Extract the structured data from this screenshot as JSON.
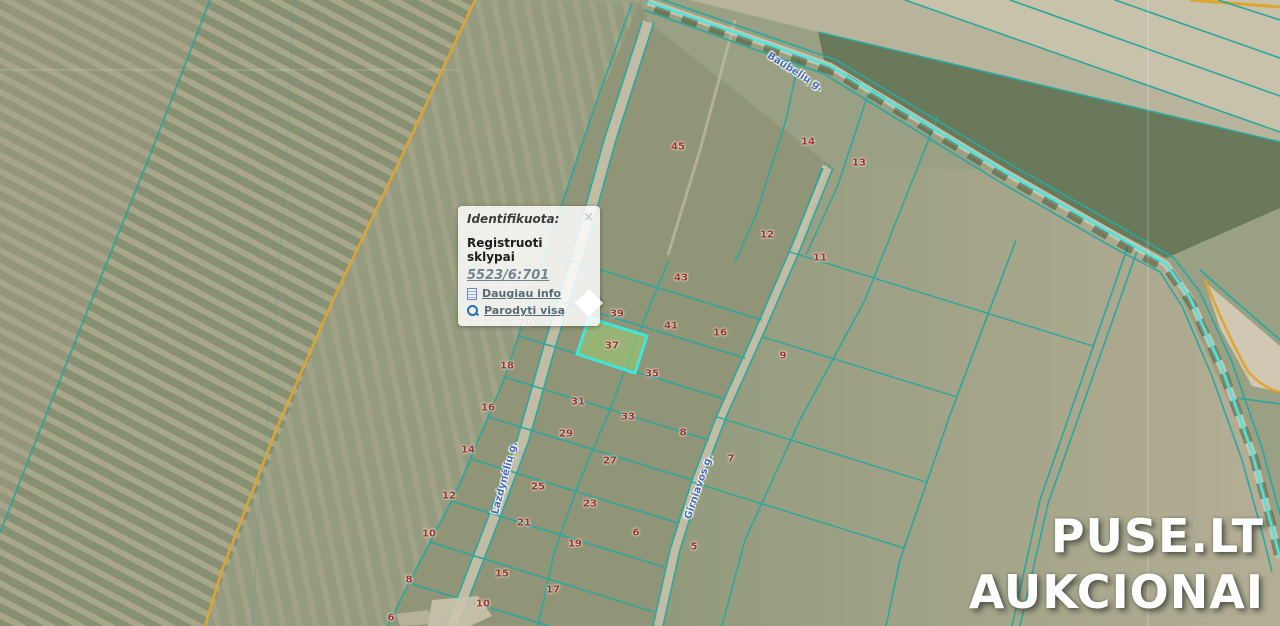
{
  "popup": {
    "title": "Identifikuota:",
    "close_label": "×",
    "section_title": "Registruoti sklypai",
    "parcel_id": "5523/6:701",
    "links": [
      {
        "label": "Daugiau info",
        "icon": "info-doc-icon"
      },
      {
        "label": "Parodyti visą",
        "icon": "magnifier-icon"
      }
    ]
  },
  "watermark": {
    "line1": "PUSE.LT",
    "line2": "AUKCIONAI"
  },
  "colors": {
    "cadastral_line": "#2aa79e",
    "road_highlight": "#47e8e2",
    "selected_parcel_stroke": "#3fe6da",
    "selected_parcel_fill": "rgba(158,206,116,0.55)",
    "field_boundary_orange": "#dfa52f",
    "parcel_number_red": "#943634",
    "street_label_blue": "#4a6db3"
  },
  "map": {
    "road_labels": [
      {
        "name": "Baubelių g.",
        "x": 795,
        "y": 72,
        "rot": 32
      },
      {
        "name": "Lazdynėlių g.",
        "x": 505,
        "y": 478,
        "rot": -75
      },
      {
        "name": "Girniavos g.",
        "x": 699,
        "y": 487,
        "rot": -71
      }
    ],
    "parcel_labels": [
      {
        "n": "45",
        "x": 678,
        "y": 147
      },
      {
        "n": "14",
        "x": 808,
        "y": 142
      },
      {
        "n": "13",
        "x": 859,
        "y": 163
      },
      {
        "n": "12",
        "x": 767,
        "y": 235
      },
      {
        "n": "11",
        "x": 820,
        "y": 258
      },
      {
        "n": "43",
        "x": 681,
        "y": 278
      },
      {
        "n": "39",
        "x": 617,
        "y": 314
      },
      {
        "n": "41",
        "x": 671,
        "y": 326
      },
      {
        "n": "16",
        "x": 720,
        "y": 333
      },
      {
        "n": "9",
        "x": 783,
        "y": 356
      },
      {
        "n": "20",
        "x": 525,
        "y": 323
      },
      {
        "n": "18",
        "x": 507,
        "y": 366
      },
      {
        "n": "37",
        "x": 612,
        "y": 346
      },
      {
        "n": "35",
        "x": 652,
        "y": 374
      },
      {
        "n": "16",
        "x": 488,
        "y": 408
      },
      {
        "n": "31",
        "x": 578,
        "y": 402
      },
      {
        "n": "33",
        "x": 628,
        "y": 417
      },
      {
        "n": "8",
        "x": 683,
        "y": 433
      },
      {
        "n": "29",
        "x": 566,
        "y": 434
      },
      {
        "n": "14",
        "x": 468,
        "y": 450
      },
      {
        "n": "27",
        "x": 610,
        "y": 461
      },
      {
        "n": "7",
        "x": 731,
        "y": 459
      },
      {
        "n": "25",
        "x": 538,
        "y": 487
      },
      {
        "n": "23",
        "x": 590,
        "y": 504
      },
      {
        "n": "12",
        "x": 449,
        "y": 496
      },
      {
        "n": "21",
        "x": 524,
        "y": 523
      },
      {
        "n": "19",
        "x": 575,
        "y": 544
      },
      {
        "n": "6",
        "x": 636,
        "y": 533
      },
      {
        "n": "10",
        "x": 429,
        "y": 534
      },
      {
        "n": "15",
        "x": 502,
        "y": 574
      },
      {
        "n": "17",
        "x": 553,
        "y": 590
      },
      {
        "n": "5",
        "x": 694,
        "y": 547
      },
      {
        "n": "10",
        "x": 483,
        "y": 604
      },
      {
        "n": "8",
        "x": 409,
        "y": 580
      },
      {
        "n": "6",
        "x": 391,
        "y": 618
      }
    ],
    "highlight": {
      "points": "589,318 647,336 635,373 577,354",
      "fill": "rgba(158,206,116,0.55)",
      "stroke": "#3fe6da",
      "label": "37"
    },
    "layers": [
      {
        "t": "pg",
        "p": "0,0 1280,0 1280,626 0,626",
        "f": "#99a083",
        "n": "base-field"
      },
      {
        "t": "pg",
        "p": "0,0 475,0 333,300 205,626 0,626",
        "f": "url(#stripesL)",
        "n": "striped-field-west"
      },
      {
        "t": "pg",
        "p": "0,0 210,0 93,297 0,533",
        "f": "#a89f86",
        "o": 0.4,
        "n": "pale-field-northwest"
      },
      {
        "t": "pg",
        "p": "475,0 640,2 590,120 545,255 503,382 458,488 408,585 388,626 205,626 333,300",
        "f": "url(#stripesM)",
        "o": 0.85,
        "n": "field-strip-mid"
      },
      {
        "t": "pg",
        "p": "640,2 590,120 545,255 503,382 458,488 408,585 388,626 663,626 680,550 702,480 727,415 763,335 800,250 833,168 648,22",
        "f": "#909577",
        "n": "parcel-block-field"
      },
      {
        "t": "pg",
        "p": "833,168 1000,170 1166,264 1252,452 1280,555 1280,626 663,626 680,550 702,480 727,415 763,335 800,250",
        "f": "url(#gradE)",
        "n": "east-field"
      },
      {
        "t": "pg",
        "p": "690,0 1280,0 1280,142 818,32",
        "f": "#b8b39b",
        "n": "north-strip-field"
      },
      {
        "t": "pg",
        "p": "905,0 1280,0 1280,132",
        "f": "#c8c2ab",
        "n": "northeast-pale-field"
      },
      {
        "t": "pg",
        "p": "818,32 1280,142 1280,208 1166,258 1000,170 824,60",
        "f": "#6a795a",
        "n": "dark-tree-band"
      },
      {
        "t": "pg",
        "p": "1205,282 1280,346 1280,392 1252,386 1220,328",
        "f": "#d0c8b2",
        "n": "pale-bay-east"
      },
      {
        "t": "pl",
        "p": "0,70 460,70",
        "s": "#ffffff",
        "w": 1,
        "o": 0.22,
        "n": "grid-line-horizontal"
      },
      {
        "t": "pl",
        "p": "293,0 287,160 272,360 258,530 252,626",
        "s": "#2aa79e",
        "w": 1,
        "o": 0.3,
        "n": "faint-boundary"
      },
      {
        "t": "pl",
        "p": "210,0 152,150 93,297 40,430 0,533",
        "s": "#2da195",
        "w": 2,
        "o": 0.8,
        "n": "west-boundary-line"
      },
      {
        "t": "pl",
        "p": "475,0 400,160 333,300 276,430 222,570 205,626",
        "s": "#dfa52f",
        "w": 2.5,
        "o": 0.95,
        "n": "orange-boundary-line"
      },
      {
        "t": "pl",
        "p": "632,3 590,120 545,255 503,382 458,488 408,585 388,626",
        "s": "#2aa79e",
        "w": 1.6,
        "n": "block-west-boundary"
      },
      {
        "t": "pl",
        "p": "735,20 700,150 668,255",
        "s": "#c9c3aa",
        "w": 3,
        "o": 0.6,
        "n": "field-lane"
      },
      {
        "t": "pl",
        "p": "800,55 786,120 756,215 735,262",
        "s": "#2aa79e",
        "w": 1.5,
        "n": "upper-parcel-line"
      },
      {
        "t": "pl",
        "p": "826,166 796,248",
        "s": "#ccc6ae",
        "w": 7,
        "o": 0.9,
        "n": "gravel-strip"
      },
      {
        "t": "pl",
        "p": "830,164 800,246",
        "s": "#2aa79e",
        "w": 1.3,
        "n": "gravel-strip-edge"
      },
      {
        "t": "pl",
        "p": "822,168 792,250",
        "s": "#2aa79e",
        "w": 1.3,
        "n": "gravel-strip-edge"
      },
      {
        "t": "pl",
        "p": "870,88 838,185 806,255",
        "s": "#2aa79e",
        "w": 1.5,
        "n": "upper-parcel-line"
      },
      {
        "t": "pl",
        "p": "938,116 865,300 800,420 745,540 722,626",
        "s": "#2aa79e",
        "w": 1.5,
        "n": "east-column-line"
      },
      {
        "t": "pl",
        "p": "648,22 610,140 578,255 550,345 523,440 495,515 470,580 452,626",
        "s": "#c6c0a7",
        "w": 11,
        "o": 0.9,
        "n": "road-west-surface"
      },
      {
        "t": "pl",
        "p": "642,22 604,140 572,255 544,345 517,440 489,515 464,580 446,626",
        "s": "#2aa79e",
        "w": 1.6,
        "n": "road-west-edge"
      },
      {
        "t": "pl",
        "p": "654,22 616,140 584,255 556,345 529,440 501,515 476,580 458,626",
        "s": "#2aa79e",
        "w": 1.6,
        "n": "road-west-edge"
      },
      {
        "t": "pl",
        "p": "828,168 795,250 758,335 722,415 697,480 675,550 658,626",
        "s": "#c6c0a7",
        "w": 9,
        "o": 0.9,
        "n": "road-east-surface"
      },
      {
        "t": "pl",
        "p": "823,168 790,250 753,335 717,415 692,480 670,550 653,626",
        "s": "#2aa79e",
        "w": 1.6,
        "n": "road-east-edge"
      },
      {
        "t": "pl",
        "p": "833,168 800,250 763,335 727,415 702,480 680,550 663,626",
        "s": "#2aa79e",
        "w": 1.6,
        "n": "road-east-edge"
      },
      {
        "t": "pl",
        "p": "668,262 640,330 610,410 580,480 555,550 538,626",
        "s": "#2aa79e",
        "w": 1.5,
        "n": "middle-column-line"
      },
      {
        "t": "pl",
        "p": "546,253 762,320",
        "s": "#2aa79e",
        "w": 1.5,
        "n": "parcel-row"
      },
      {
        "t": "pl",
        "p": "533,293 745,358",
        "s": "#2aa79e",
        "w": 1.5,
        "n": "parcel-row"
      },
      {
        "t": "pl",
        "p": "519,336 724,399",
        "s": "#2aa79e",
        "w": 1.5,
        "n": "parcel-row"
      },
      {
        "t": "pl",
        "p": "504,377 709,440",
        "s": "#2aa79e",
        "w": 1.5,
        "n": "parcel-row"
      },
      {
        "t": "pl",
        "p": "488,417 692,480",
        "s": "#2aa79e",
        "w": 1.5,
        "n": "parcel-row"
      },
      {
        "t": "pl",
        "p": "471,459 678,523",
        "s": "#2aa79e",
        "w": 1.5,
        "n": "parcel-row"
      },
      {
        "t": "pl",
        "p": "451,501 664,567",
        "s": "#2aa79e",
        "w": 1.5,
        "n": "parcel-row"
      },
      {
        "t": "pl",
        "p": "430,542 654,612",
        "s": "#2aa79e",
        "w": 1.5,
        "n": "parcel-row"
      },
      {
        "t": "pl",
        "p": "412,584 549,626",
        "s": "#2aa79e",
        "w": 1.5,
        "n": "parcel-row"
      },
      {
        "t": "pl",
        "p": "790,252 1093,346",
        "s": "#2aa79e",
        "w": 1.4,
        "n": "east-parcel-row"
      },
      {
        "t": "pl",
        "p": "763,337 957,397",
        "s": "#2aa79e",
        "w": 1.4,
        "n": "east-parcel-row"
      },
      {
        "t": "pl",
        "p": "717,417 926,482",
        "s": "#2aa79e",
        "w": 1.4,
        "n": "east-parcel-row"
      },
      {
        "t": "pl",
        "p": "692,482 904,548",
        "s": "#2aa79e",
        "w": 1.4,
        "n": "east-parcel-row"
      },
      {
        "t": "pl",
        "p": "1128,246 1040,500 1012,626",
        "s": "#2aa79e",
        "w": 1.6,
        "n": "long-field-line"
      },
      {
        "t": "pl",
        "p": "1137,251 1048,504 1020,626",
        "s": "#2aa79e",
        "w": 1.6,
        "n": "long-field-line"
      },
      {
        "t": "pl",
        "p": "1016,240 950,415 900,560 886,626",
        "s": "#2aa79e",
        "w": 1.6,
        "n": "long-field-line"
      },
      {
        "t": "pl",
        "p": "1200,270 1280,340",
        "s": "#2aa79e",
        "w": 1.6,
        "n": "east-edge-line"
      },
      {
        "t": "pl",
        "p": "1237,398 1280,404",
        "s": "#2aa79e",
        "w": 1.6,
        "n": "east-edge-line"
      },
      {
        "t": "pa",
        "p": "M1205,280 Q1226,332 1247,370 Q1262,388 1280,392",
        "s": "#dfa52f",
        "w": 2.5,
        "n": "orange-bay-line"
      },
      {
        "t": "pl",
        "p": "1190,0 1280,7",
        "s": "#dfa52f",
        "w": 3,
        "n": "orange-corner-line"
      },
      {
        "t": "pl",
        "p": "818,32 1280,142",
        "s": "#2aa79e",
        "w": 1.6,
        "n": "north-parallel-line"
      },
      {
        "t": "pl",
        "p": "905,0 1280,132",
        "s": "#2aa79e",
        "w": 1.6,
        "n": "north-parallel-line"
      },
      {
        "t": "pl",
        "p": "1010,0 1280,96",
        "s": "#2aa79e",
        "w": 1.6,
        "n": "north-parallel-line"
      },
      {
        "t": "pl",
        "p": "1115,0 1280,58",
        "s": "#2aa79e",
        "w": 1.6,
        "n": "north-parallel-line"
      },
      {
        "t": "pl",
        "p": "1218,0 1280,20",
        "s": "#2aa79e",
        "w": 1.6,
        "n": "north-parallel-line"
      },
      {
        "t": "pl",
        "p": "648,2 830,66 1005,172 1120,238 1166,264 1190,298 1222,368 1252,452 1270,520 1280,558",
        "s": "#cfc8b1",
        "w": 7,
        "o": 0.9,
        "n": "main-road-surface"
      },
      {
        "t": "pl",
        "p": "655,8 835,72 1008,178 1122,244 1168,270 1192,304 1224,374 1254,458 1272,526 1280,562",
        "s": "rgba(60,78,46,0.5)",
        "w": 9,
        "d": "16 13",
        "n": "roadside-trees"
      },
      {
        "t": "pl",
        "p": "652,-4 836,60 1010,164 1126,230 1174,258 1200,292 1232,362 1262,448 1280,514",
        "s": "#2aa79e",
        "w": 1.6,
        "n": "main-road-edge"
      },
      {
        "t": "pl",
        "p": "644,10 824,74 1000,182 1114,248 1160,272 1182,306 1212,376 1242,460 1262,532 1272,572",
        "s": "#2aa79e",
        "w": 1.6,
        "n": "main-road-edge"
      },
      {
        "t": "pl",
        "p": "648,2 830,66 1005,172 1120,238 1166,264 1190,298 1222,368 1252,452 1270,520 1280,558",
        "s": "#47e8e2",
        "w": 2.5,
        "n": "main-road-centerline"
      },
      {
        "t": "pg",
        "p": "432,600 478,596 492,616 470,626 428,626",
        "f": "#ccc6ad",
        "o": 0.85,
        "n": "farmstead-patch"
      },
      {
        "t": "pg",
        "p": "396,614 428,610 436,624 400,626",
        "f": "#c5bfa6",
        "o": 0.7,
        "n": "farmstead-patch"
      },
      {
        "t": "pl",
        "p": "1148,0 1148,626",
        "s": "#ffffff",
        "w": 1,
        "o": 0.3,
        "n": "grid-line-vertical"
      }
    ]
  }
}
